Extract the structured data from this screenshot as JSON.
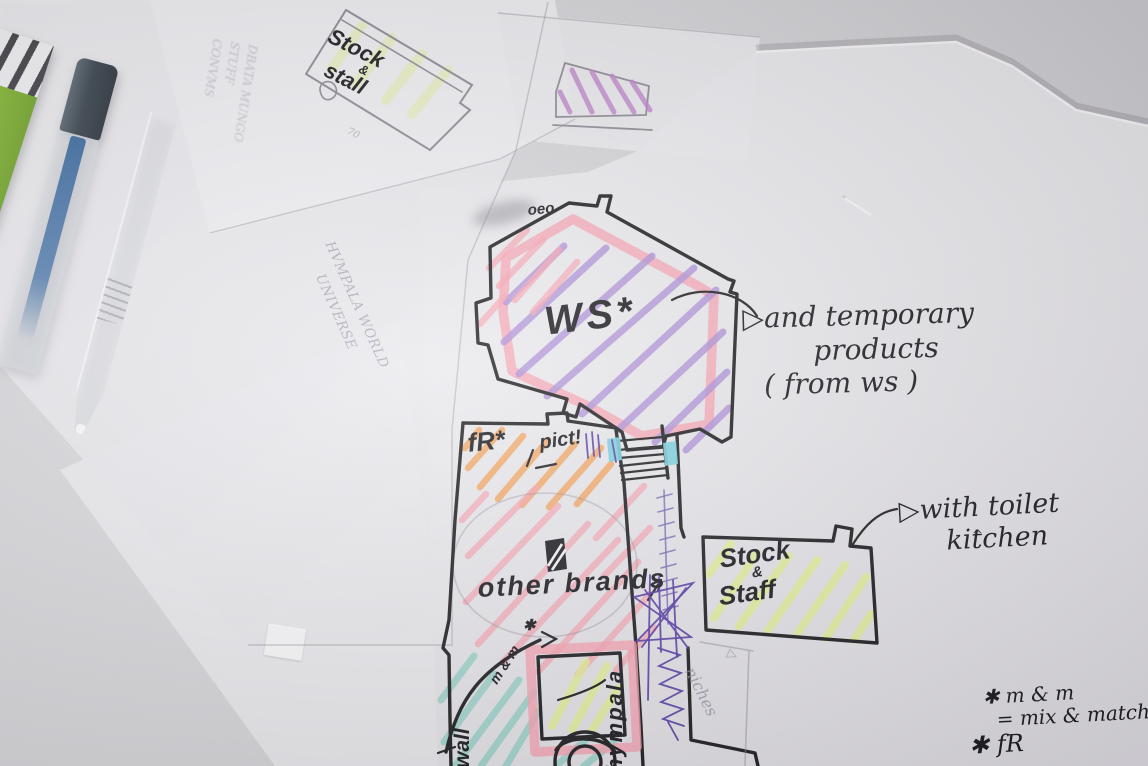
{
  "photo": {
    "plan_labels": {
      "ws_room": "WS*",
      "oeo_scribble": "oeo",
      "fr_area": "fR*",
      "pict_note": "pict!",
      "other_brands": "other brands",
      "wall_note": "wall",
      "hympala_note": "hympala",
      "mm_arc_label": "m & m",
      "mm_star": "✱",
      "niches_note": "niches",
      "niches_arrow": "▷"
    },
    "rooms": {
      "stock_staff": {
        "line1": "Stock",
        "amp": "&",
        "line2": "Staff"
      },
      "stock_stall": {
        "line1": "Stock",
        "amp": "&",
        "line2": "stall"
      }
    },
    "annotations": {
      "temporary_products": {
        "arrow": "▷",
        "line1": "and temporary",
        "line2": "products",
        "line3": "( from ws )"
      },
      "toilet_kitchen": {
        "arrow": "▷",
        "line1": "with toilet",
        "line2": "kitchen",
        "caret": "^"
      },
      "legend_mm": {
        "line1": "✱ m & m",
        "line2": "= mix & match",
        "line3": "✱ fR"
      }
    },
    "faint_texts": {
      "brand_line1": "HVMPALA WORLD",
      "brand_line2": "UNIVERSE",
      "mirror_line1": "DBATA MUNGO",
      "mirror_line2": "STUFF",
      "mirror_line3": "CONVMS",
      "pencil_70": "70"
    },
    "colors": {
      "pink_highlight": "#f8a3b2",
      "purple_marker": "#ab8ed8",
      "orange_marker": "#f4a55f",
      "lime_marker": "#e6f294",
      "teal_marker": "#6fc9b7",
      "cyan_marker": "#7ad0de",
      "black_pen": "#1f1e22",
      "purple_pen": "#5b3fa8",
      "pencil_gray": "#8f8c96",
      "magenta_marker": "#c083cc"
    }
  }
}
